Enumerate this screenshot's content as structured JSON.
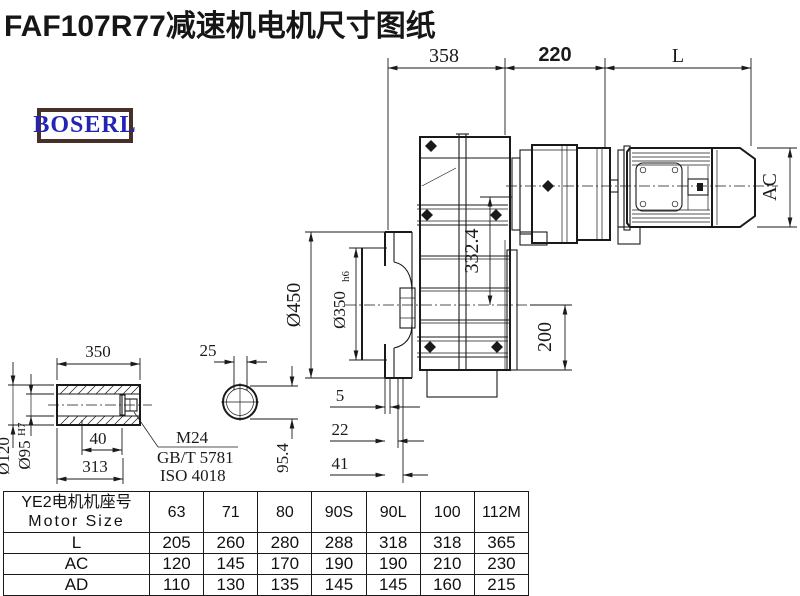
{
  "title": "FAF107R77减速机电机尺寸图纸",
  "logo": {
    "text": "BOSERL"
  },
  "colors": {
    "line": "#1a1a1a",
    "logo_border": "#47302a",
    "logo_text": "#2424b4",
    "background": "#ffffff"
  },
  "dims": {
    "top_358": "358",
    "top_220": "220",
    "top_L": "L",
    "right_AC": "AC",
    "flange_od": "Ø450",
    "flange_spigot": "Ø350",
    "flange_spigot_tol": "h6",
    "height_332": "332.4",
    "height_200": "200",
    "offset_5": "5",
    "offset_22": "22",
    "offset_41": "41",
    "shaft_350": "350",
    "shaft_25": "25",
    "shaft_od": "Ø120",
    "shaft_bore": "Ø95",
    "shaft_bore_tol": "H7",
    "shaft_40": "40",
    "shaft_313": "313",
    "shaft_954": "95.4",
    "note_m24": "M24",
    "note_gbt": "GB/T 5781",
    "note_iso": "ISO 4018"
  },
  "table": {
    "header_line1": "YE2电机机座号",
    "header_line2": "Motor Size",
    "columns": [
      "63",
      "71",
      "80",
      "90S",
      "90L",
      "100",
      "112M"
    ],
    "rows": [
      {
        "label": "L",
        "values": [
          "205",
          "260",
          "280",
          "288",
          "318",
          "318",
          "365"
        ]
      },
      {
        "label": "AC",
        "values": [
          "120",
          "145",
          "170",
          "190",
          "190",
          "210",
          "230"
        ]
      },
      {
        "label": "AD",
        "values": [
          "110",
          "130",
          "135",
          "145",
          "145",
          "160",
          "215"
        ]
      }
    ]
  }
}
